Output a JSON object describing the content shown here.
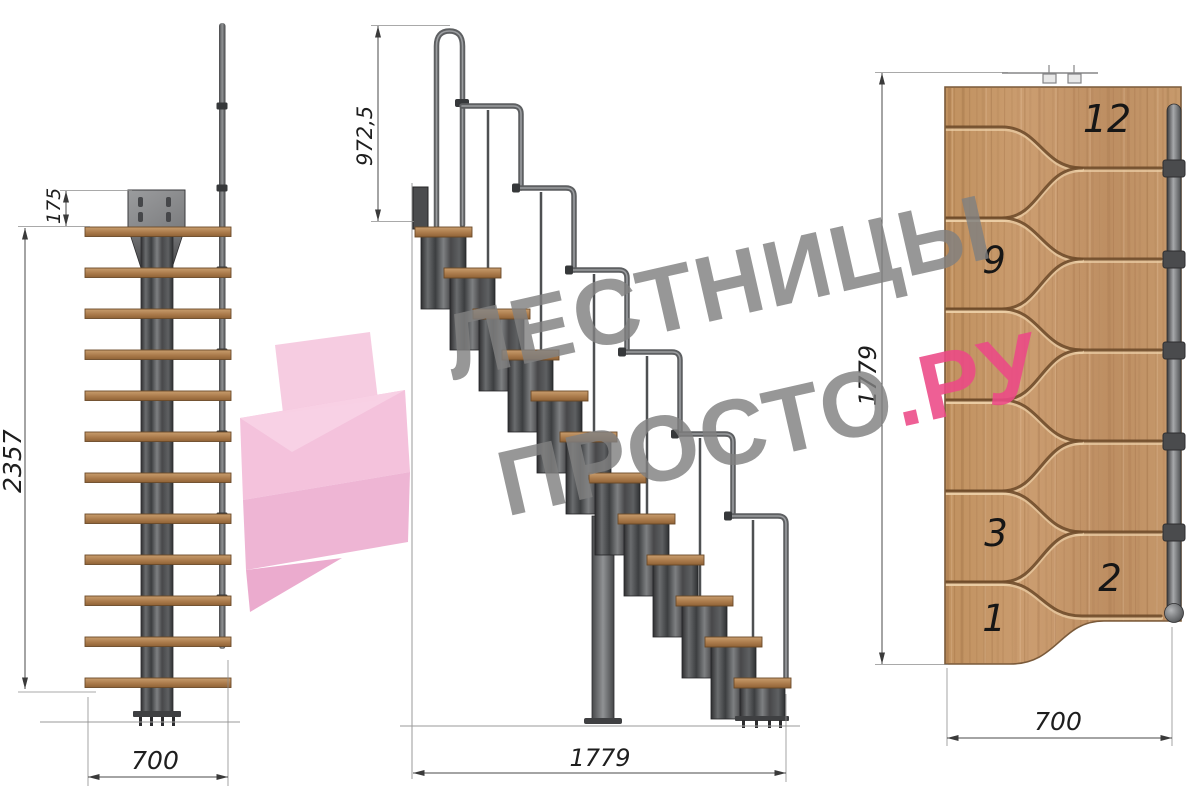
{
  "watermark": {
    "line1": "ЛЕСТНИЦЫ",
    "line2_gray": "ПРОСТО",
    "line2_pink": ".РУ",
    "gray_color": "#a0a0a0",
    "pink_color": "#ec4987"
  },
  "front_view": {
    "dim_plate_offset": "175",
    "dim_total_height": "2357",
    "dim_width": "700"
  },
  "side_view": {
    "dim_handrail_height": "972,5",
    "dim_length": "1779"
  },
  "plan_view": {
    "dim_length": "1779",
    "dim_width": "700",
    "tread_labels": [
      "12",
      "9",
      "3",
      "2",
      "1"
    ]
  },
  "colors": {
    "wood": "#c59a6a",
    "wood_groove": "#6f4b2a",
    "metal": "#4a4c4e",
    "dimension_line": "#4a4a4a",
    "watermark_gray": "#a0a0a0",
    "watermark_pink": "#ec4987"
  }
}
